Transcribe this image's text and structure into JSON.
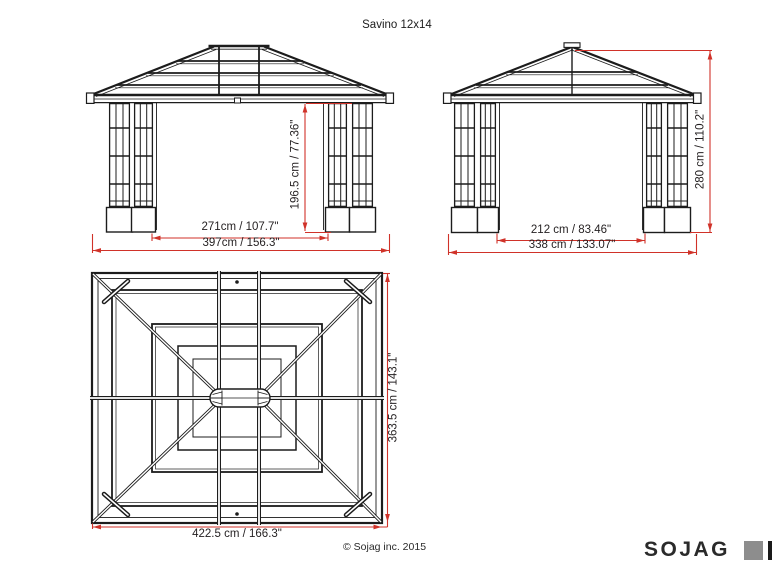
{
  "title": "Savino 12x14",
  "views": {
    "front_elevation": {
      "dim_opening_width": "271cm / 107.7\"",
      "dim_total_width": "397cm / 156.3\"",
      "dim_post_height": "196.5 cm / 77.36\""
    },
    "side_elevation": {
      "dim_opening_depth": "212 cm / 83.46\"",
      "dim_total_depth": "338 cm / 133.07\"",
      "dim_total_height": "280 cm / 110.2\""
    },
    "roof_plan": {
      "dim_roof_width": "422.5 cm / 166.3\"",
      "dim_roof_depth": "363.5 cm / 143.1\""
    }
  },
  "footer": {
    "copyright": "© Sojag inc. 2015"
  },
  "logo": {
    "wordmark": "SOJAG"
  },
  "colors": {
    "dimension_red": "#d03229",
    "line_black": "#1c1c1c",
    "logo_gray": "#8d8d8d"
  }
}
